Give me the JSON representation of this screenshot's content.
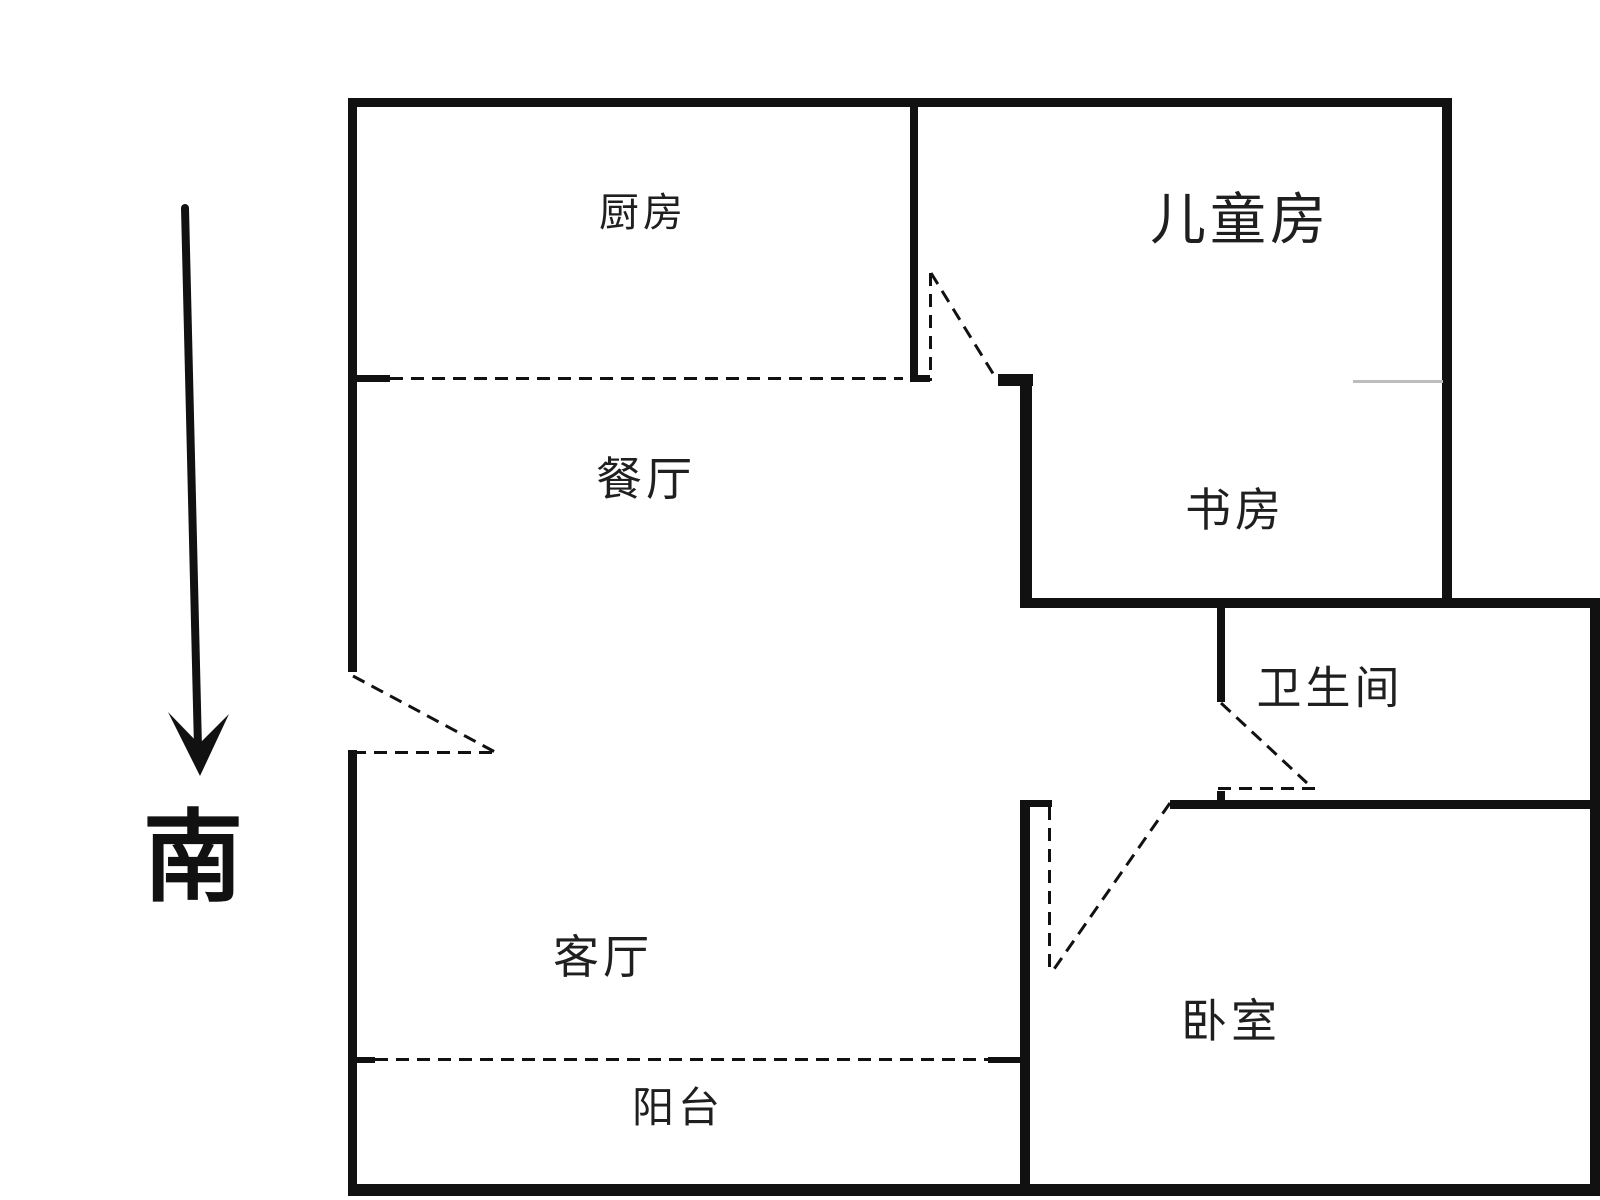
{
  "colors": {
    "wall": "#111111",
    "label": "#1f1f1f",
    "faint_line": "#bdbdbd",
    "background": "#ffffff"
  },
  "compass": {
    "label": "南",
    "x": 193,
    "y": 858,
    "font_size": 100,
    "arrow": {
      "shaft": {
        "x1": 185,
        "y1": 208,
        "x2": 198,
        "y2": 748,
        "width": 8
      },
      "head_points": "168,712 199,744 229,714 200,776"
    }
  },
  "rooms": [
    {
      "id": "kitchen",
      "label": "厨房",
      "x": 643,
      "y": 213,
      "font_size": 40
    },
    {
      "id": "children-room",
      "label": "儿童房",
      "x": 1240,
      "y": 220,
      "font_size": 56
    },
    {
      "id": "dining-room",
      "label": "餐厅",
      "x": 646,
      "y": 479,
      "font_size": 46
    },
    {
      "id": "study",
      "label": "书房",
      "x": 1235,
      "y": 510,
      "font_size": 46
    },
    {
      "id": "bathroom",
      "label": "卫生间",
      "x": 1330,
      "y": 688,
      "font_size": 45
    },
    {
      "id": "living-room",
      "label": "客厅",
      "x": 603,
      "y": 957,
      "font_size": 46
    },
    {
      "id": "bedroom",
      "label": "卧室",
      "x": 1231,
      "y": 1021,
      "font_size": 46
    },
    {
      "id": "balcony",
      "label": "阳台",
      "x": 678,
      "y": 1108,
      "font_size": 42
    }
  ],
  "walls": [
    {
      "id": "top-wall",
      "x": 348,
      "y": 98,
      "w": 1104,
      "h": 9
    },
    {
      "id": "left-wall-upper",
      "x": 348,
      "y": 98,
      "w": 9,
      "h": 574
    },
    {
      "id": "left-wall-lower",
      "x": 348,
      "y": 750,
      "w": 9,
      "h": 443
    },
    {
      "id": "bottom-wall",
      "x": 348,
      "y": 1184,
      "w": 1252,
      "h": 12
    },
    {
      "id": "right-outer-wall",
      "x": 1590,
      "y": 598,
      "w": 10,
      "h": 598
    },
    {
      "id": "children-right-wall",
      "x": 1442,
      "y": 98,
      "w": 10,
      "h": 509
    },
    {
      "id": "kitchen-children-divider",
      "x": 910,
      "y": 107,
      "w": 8,
      "h": 274
    },
    {
      "id": "kitchen-window-left-stub",
      "x": 348,
      "y": 375,
      "w": 42,
      "h": 7
    },
    {
      "id": "divider-foot-stub",
      "x": 910,
      "y": 375,
      "w": 20,
      "h": 7
    },
    {
      "id": "children-door-right-stub",
      "x": 998,
      "y": 374,
      "w": 35,
      "h": 12
    },
    {
      "id": "study-left-wall",
      "x": 1020,
      "y": 378,
      "w": 12,
      "h": 229
    },
    {
      "id": "bathroom-top-wall",
      "x": 1020,
      "y": 598,
      "w": 580,
      "h": 10
    },
    {
      "id": "bathroom-left-wall",
      "x": 1217,
      "y": 608,
      "w": 8,
      "h": 94
    },
    {
      "id": "bathroom-door-bottom-tick",
      "x": 1217,
      "y": 791,
      "w": 8,
      "h": 17
    },
    {
      "id": "bedroom-top-wall",
      "x": 1170,
      "y": 800,
      "w": 430,
      "h": 9
    },
    {
      "id": "bedroom-door-left-stub",
      "x": 1026,
      "y": 800,
      "w": 26,
      "h": 7
    },
    {
      "id": "bedroom-left-wall",
      "x": 1020,
      "y": 800,
      "w": 10,
      "h": 396
    },
    {
      "id": "balcony-left-stub",
      "x": 348,
      "y": 1057,
      "w": 27,
      "h": 6
    },
    {
      "id": "balcony-right-stub",
      "x": 988,
      "y": 1057,
      "w": 32,
      "h": 6
    }
  ],
  "window_lines": [
    {
      "id": "kitchen-window-line",
      "orient": "h",
      "x": 390,
      "y": 377,
      "len": 513
    },
    {
      "id": "balcony-window-line",
      "orient": "h",
      "x": 375,
      "y": 1058,
      "len": 613
    }
  ],
  "door_leaves": [
    {
      "id": "children-door-leaf",
      "orient": "v",
      "x": 929,
      "y": 273,
      "len": 108
    },
    {
      "id": "bedroom-door-leaf",
      "orient": "v",
      "x": 1048,
      "y": 807,
      "len": 166
    },
    {
      "id": "entry-door-leaf",
      "orient": "h",
      "x": 353,
      "y": 751,
      "len": 144
    },
    {
      "id": "bathroom-door-leaf",
      "orient": "h",
      "x": 1218,
      "y": 787,
      "len": 99
    }
  ],
  "door_swings": [
    {
      "id": "children-door-swing",
      "x1": 931,
      "y1": 273,
      "x2": 997,
      "y2": 380
    },
    {
      "id": "entry-door-swing",
      "x1": 353,
      "y1": 676,
      "x2": 495,
      "y2": 752
    },
    {
      "id": "bathroom-door-swing",
      "x1": 1221,
      "y1": 703,
      "x2": 1307,
      "y2": 783
    },
    {
      "id": "bedroom-door-swing",
      "x1": 1170,
      "y1": 803,
      "x2": 1052,
      "y2": 972
    }
  ],
  "faint_lines": [
    {
      "id": "children-study-boundary",
      "x": 1353,
      "y": 380,
      "len": 90
    }
  ]
}
